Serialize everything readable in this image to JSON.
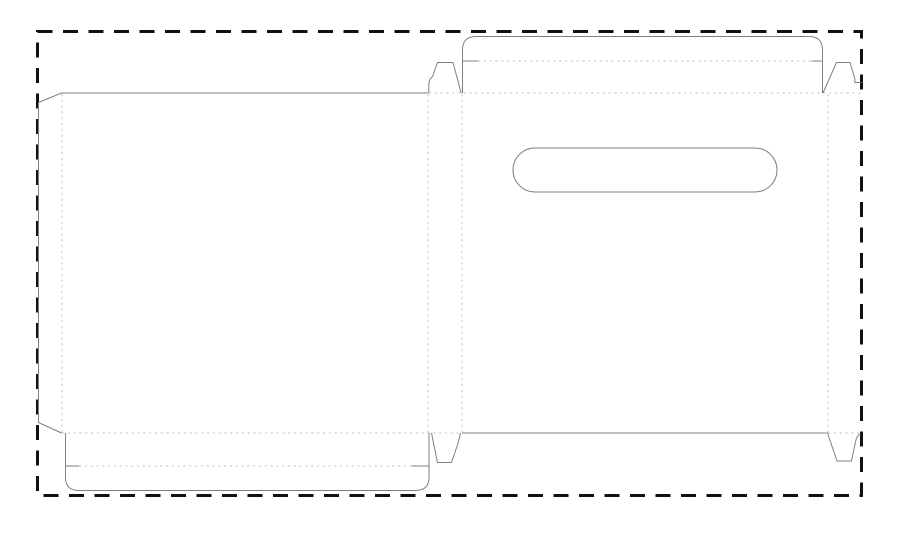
{
  "canvas": {
    "width": 900,
    "height": 537,
    "background": "#ffffff"
  },
  "colors": {
    "cut_line": "#7f7f7f",
    "fold_line": "#c3c3c3",
    "boundary": "#111111"
  },
  "boundary": {
    "name": "sheet-boundary-dashed-rect",
    "x": 37.5,
    "y": 31.5,
    "width": 824,
    "height": 464,
    "stroke_width": 3,
    "dash": "15 10.5"
  },
  "line_styles": {
    "fold_dash": "2.2 3.6"
  },
  "cut_lines": [
    {
      "name": "left-panel-and-glue-flap-outline",
      "d": "M 428,93 L 61.5,93 L 38.5,102.5 L 38.5,422.5 L 61.5,433"
    },
    {
      "name": "top-tuck-flap-outline",
      "d": "M 462.5,93 L 462.5,50 Q 462.5,36.5 476,36.5 L 809,36.5 Q 822.5,36.5 822.5,50 L 822.5,93"
    },
    {
      "name": "top-tuck-flap-left-slit",
      "d": "M 462.5,61 L 478,61"
    },
    {
      "name": "top-tuck-flap-right-slit",
      "d": "M 811.5,61 L 822.5,61"
    },
    {
      "name": "top-center-dust-tab",
      "d": "M 428.8,93 L 428.8,84.5 Q 429,79.5 432.5,76.5 L 437.5,62.5 L 453,62.5 L 461.2,93"
    },
    {
      "name": "top-right-dust-tab",
      "d": "M 823,93 L 836.5,62.5 L 850,62.5 L 854.8,78.5 L 854.8,82.5 L 861.5,82.5"
    },
    {
      "name": "right-panel-bottom-edge",
      "d": "M 462,433 L 827.5,433"
    },
    {
      "name": "bottom-center-dust-tab",
      "d": "M 431.5,433 L 437.5,462.5 L 451.5,462.5 L 458,443.5 L 460.5,433"
    },
    {
      "name": "bottom-right-dust-tab",
      "d": "M 827.5,433 L 837,461 L 851.5,461 L 855.5,442 Q 856.5,435.5 860.5,433.8"
    },
    {
      "name": "bottom-tuck-flap-outline",
      "d": "M 65.5,433 L 65.5,477.5 Q 65.5,490.5 79,490.5 L 415.5,490.5 Q 429,490.5 429,477.5 L 429,433"
    },
    {
      "name": "bottom-tuck-flap-left-slit",
      "d": "M 65.5,466 L 79,466"
    },
    {
      "name": "bottom-tuck-flap-right-slit",
      "d": "M 412,466 L 429,466"
    },
    {
      "name": "handle-slot-cutout",
      "d": "M 535,148 L 755,148 A 22,22 0 0 1 755,192 L 535,192 A 22,22 0 0 1 535,148 Z"
    }
  ],
  "fold_lines": [
    {
      "name": "glue-flap-fold",
      "d": "M 62,94 L 62,432.5"
    },
    {
      "name": "spine-left-fold",
      "d": "M 428,94 L 428,432.5"
    },
    {
      "name": "spine-right-fold",
      "d": "M 462,94 L 462,432.5"
    },
    {
      "name": "right-strip-fold",
      "d": "M 828,94 L 828,432.5"
    },
    {
      "name": "top-panels-fold",
      "d": "M 428.8,93 L 861.5,93"
    },
    {
      "name": "bottom-left-panel-fold",
      "d": "M 62,433 L 462,433"
    },
    {
      "name": "bottom-right-strip-fold",
      "d": "M 828,433 L 861.5,433"
    },
    {
      "name": "top-tuck-fold",
      "d": "M 478,61 L 811.5,61"
    },
    {
      "name": "bottom-tuck-fold",
      "d": "M 79,466 L 412,466"
    }
  ]
}
